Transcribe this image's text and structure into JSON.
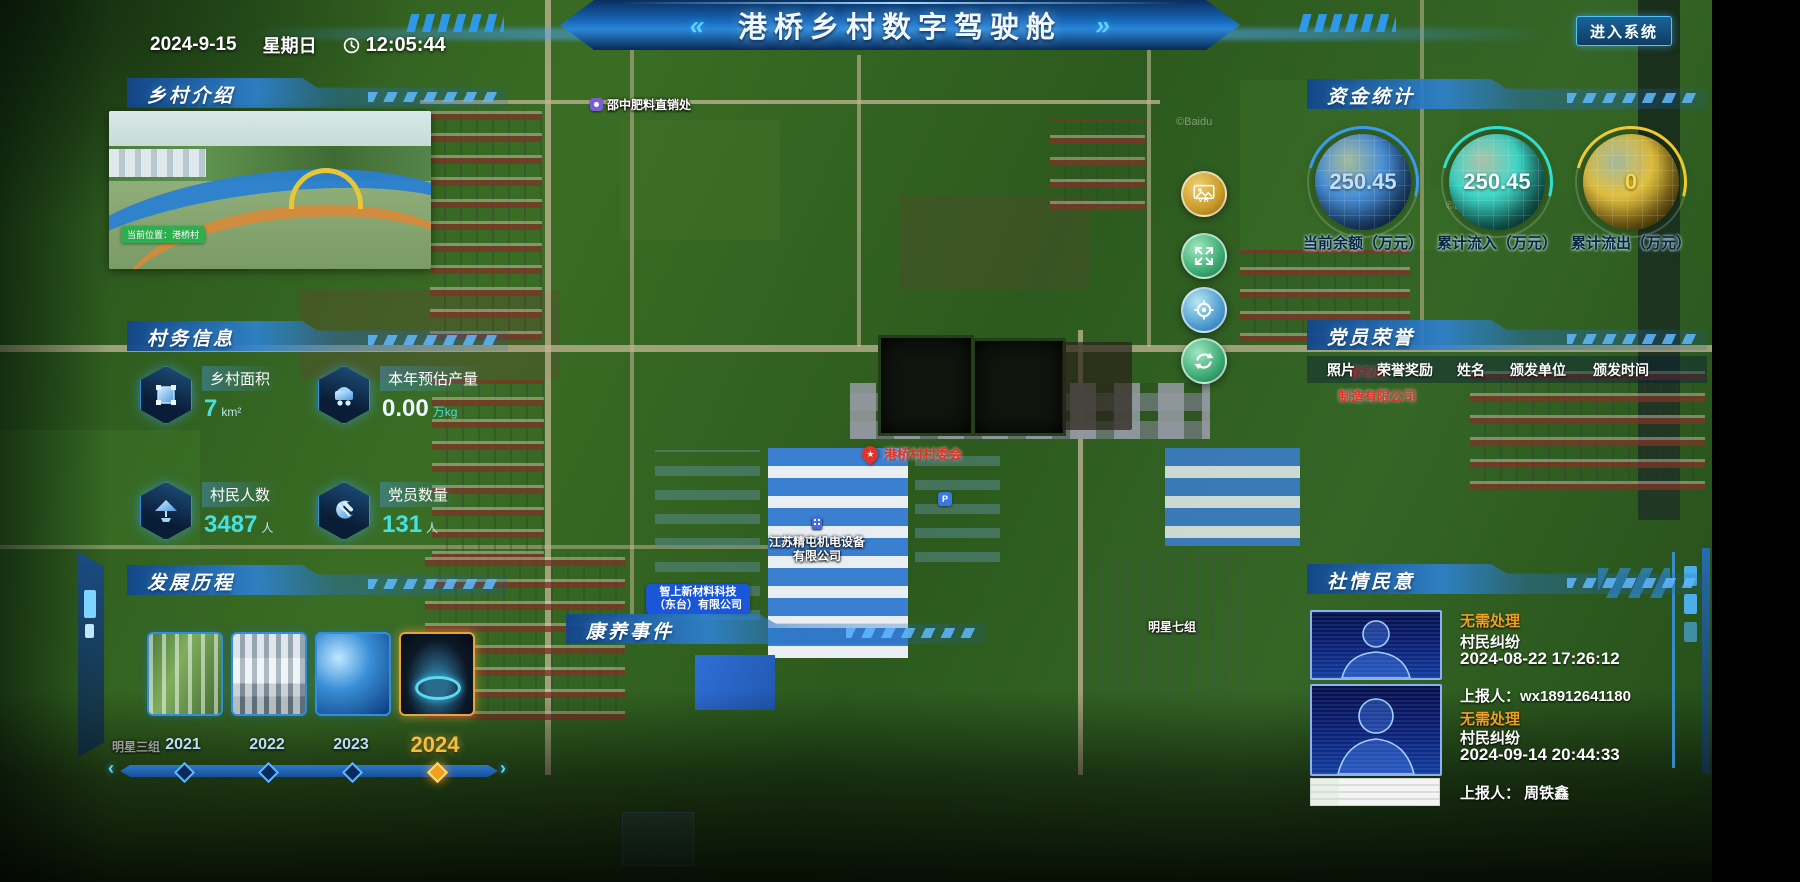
{
  "header": {
    "date": "2024-9-15",
    "weekday": "星期日",
    "time": "12:05:44",
    "title": "港桥乡村数字驾驶舱",
    "chevron_left": "«",
    "chevron_right": "»",
    "enter_button": "进入系统"
  },
  "colors": {
    "accent_cyan": "#46e0e0",
    "accent_gold": "#f2c040",
    "status_orange": "#f0a020",
    "alert_red": "#e03428"
  },
  "panels": {
    "intro": {
      "title": "乡村介绍",
      "photo_tag": "当前位置：港桥村"
    },
    "affairs": {
      "title": "村务信息",
      "stats": [
        {
          "label": "乡村面积",
          "value": "7",
          "unit": "km²"
        },
        {
          "label": "本年预估产量",
          "value": "0.00",
          "unit": "万kg"
        },
        {
          "label": "村民人数",
          "value": "3487",
          "unit": "人"
        },
        {
          "label": "党员数量",
          "value": "131",
          "unit": "人"
        }
      ]
    },
    "history": {
      "title": "发展历程",
      "prev": "‹",
      "next": "›",
      "years": [
        {
          "label": "2021",
          "active": false
        },
        {
          "label": "2022",
          "active": false
        },
        {
          "label": "2023",
          "active": false
        },
        {
          "label": "2024",
          "active": true
        }
      ]
    },
    "funds": {
      "title": "资金统计",
      "gauges": [
        {
          "value": "250.45",
          "label": "当前余额（万元）"
        },
        {
          "value": "250.45",
          "label": "累计流入（万元）"
        },
        {
          "value": "0",
          "label": "累计流出（万元）"
        }
      ]
    },
    "honors": {
      "title": "党员荣誉",
      "columns": [
        "照片",
        "荣誉奖励",
        "姓名",
        "颁发单位",
        "颁发时间"
      ]
    },
    "sentiment": {
      "title": "社情民意",
      "items": [
        {
          "status": "无需处理",
          "type": "村民纠纷",
          "time": "2024-08-22 17:26:12",
          "reporter": "上报人：wx18912641180"
        },
        {
          "status": "无需处理",
          "type": "村民纠纷",
          "time": "2024-09-14 20:44:33",
          "reporter": "上报人： 周铁鑫"
        }
      ]
    },
    "health_events": {
      "title": "康养事件"
    }
  },
  "map": {
    "controls": {
      "vr_label": "VR"
    },
    "poi": {
      "fertilizer": "邵中肥料直销处",
      "committee": "港桥村村委会",
      "committee_star": "★",
      "company1_line1": "江苏精屯机电设备",
      "company1_line2": "有限公司",
      "company2_line1": "智上新材料科技",
      "company2_line2": "（东台）有限公司",
      "group7": "明星七组",
      "group3": "明星三组",
      "red_line1": "睿智能",
      "red_line2": "制造有限公司",
      "baidu": "©Baidu"
    }
  }
}
